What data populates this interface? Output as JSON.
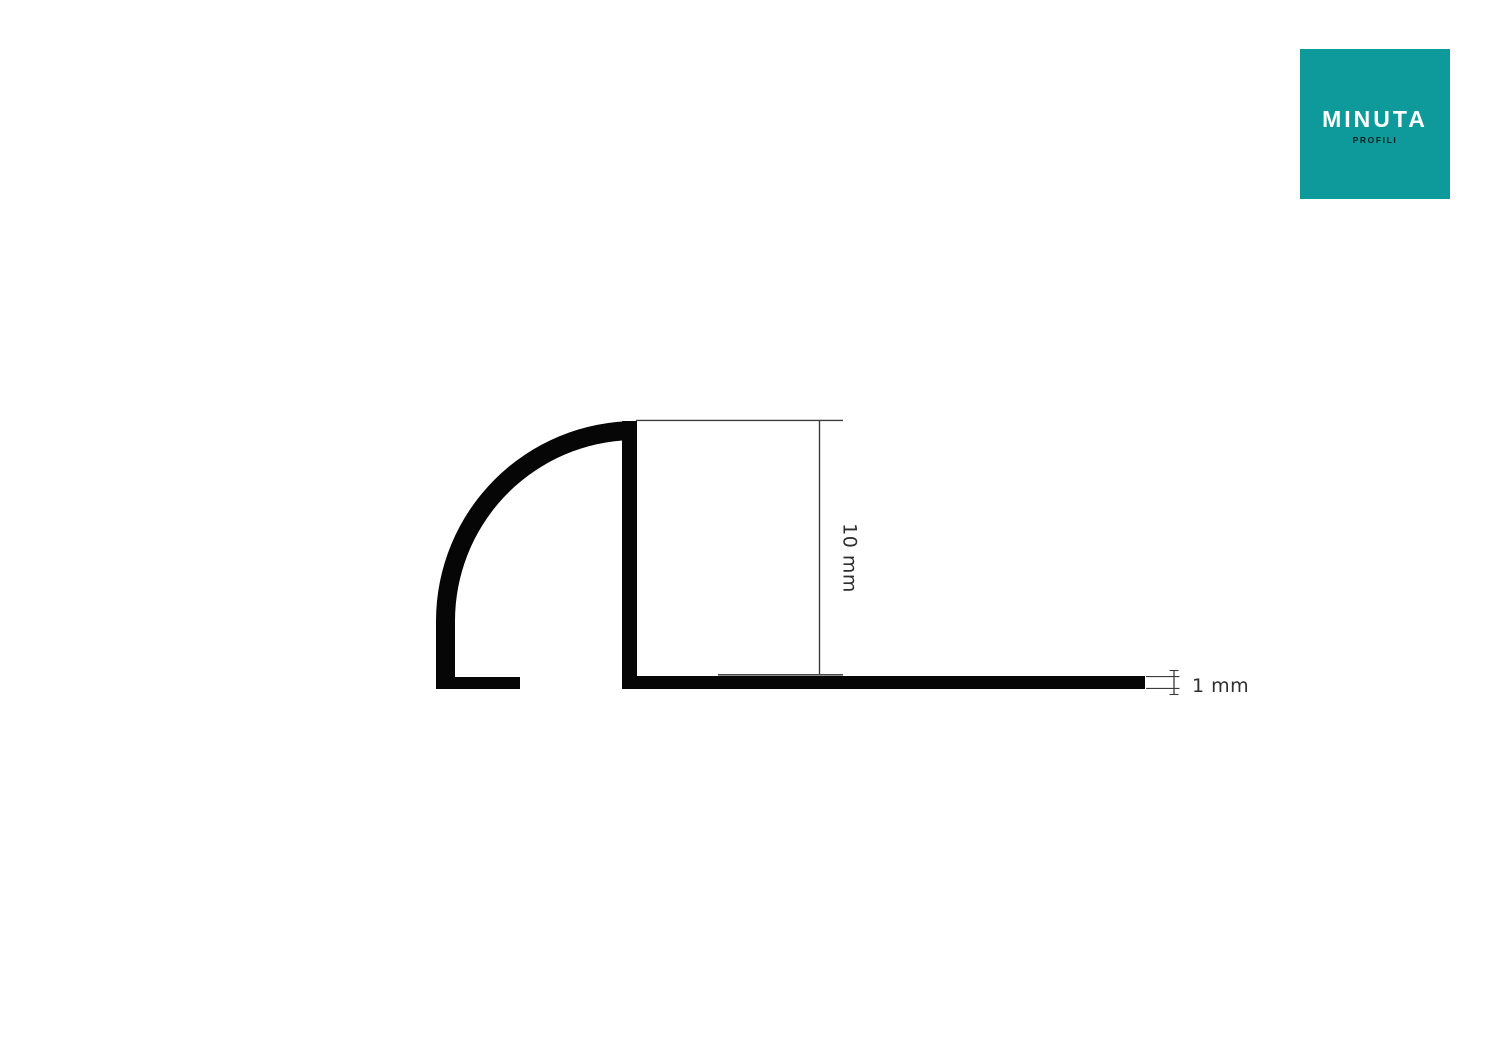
{
  "page": {
    "background_color": "#ffffff"
  },
  "logo": {
    "brand": "MINUTA",
    "subtitle": "PROFILI",
    "bg_color": "#0e999b",
    "brand_color": "#ffffff",
    "subtitle_color": "#0b2120"
  },
  "diagram": {
    "height_dimension_label": "10 mm",
    "thickness_dimension_label": "1 mm",
    "colors": {
      "profile": "#060606",
      "dimension_line": "#3c3c3c",
      "base_overlay_line": "#4a4a4a",
      "label_text": "#2e2e2e"
    }
  }
}
